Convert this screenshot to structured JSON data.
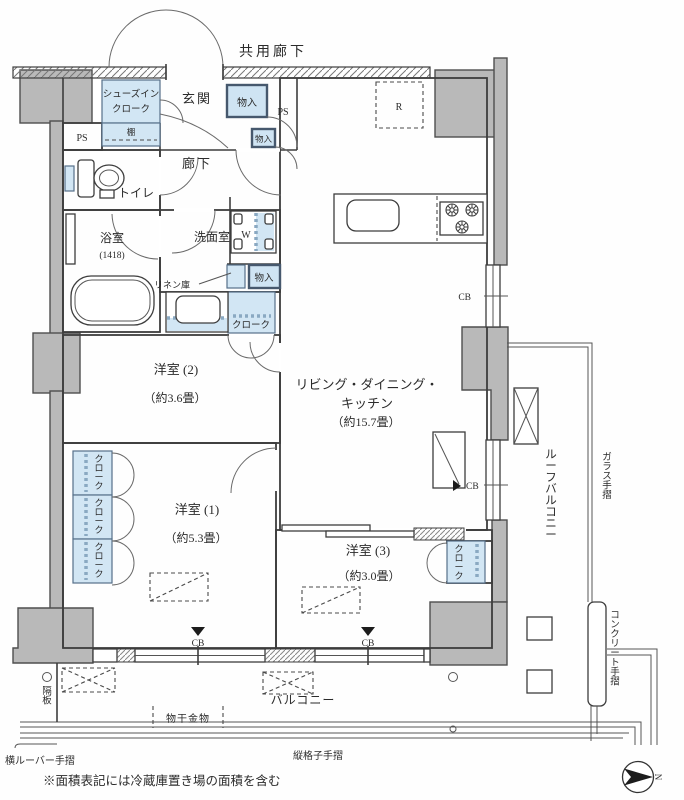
{
  "labels": {
    "common_corridor": "共用廊下",
    "entrance": "玄関",
    "shoes_closet_1": "シューズイン",
    "shoes_closet_2": "クローク",
    "shelf": "棚",
    "storage": "物入",
    "ps": "PS",
    "hallway": "廊下",
    "toilet": "トイレ",
    "bath": "浴室",
    "bath_size": "(1418)",
    "washroom": "洗面室",
    "washer": "W",
    "linen": "リネン庫",
    "cloak": "クローク",
    "ldk_line1": "リビング・ダイニング・",
    "ldk_line2": "キッチン",
    "ldk_size": "（約15.7畳）",
    "fridge": "R",
    "bed2": "洋室 (2)",
    "bed2_size": "（約3.6畳）",
    "bed1": "洋室 (1)",
    "bed1_size": "（約5.3畳）",
    "bed3": "洋室 (3)",
    "bed3_size": "（約3.0畳）",
    "roof_balcony": "ルーフバルコニー",
    "glass_rail": "ガラス手摺",
    "concrete_rail": "コンクリート手摺",
    "balcony": "バルコニー",
    "laundry_fitting": "物干金物",
    "partition": "隔板",
    "louver_rail": "横ルーバー手摺",
    "lattice_rail": "縦格子手摺",
    "cb": "CB",
    "north": "N",
    "note": "※面積表記には冷蔵庫置き場の面積を含む"
  },
  "colors": {
    "wall_gray": "#b9b9b9",
    "storage_blue": "#d2e6f4",
    "line": "#3d3d3d"
  }
}
